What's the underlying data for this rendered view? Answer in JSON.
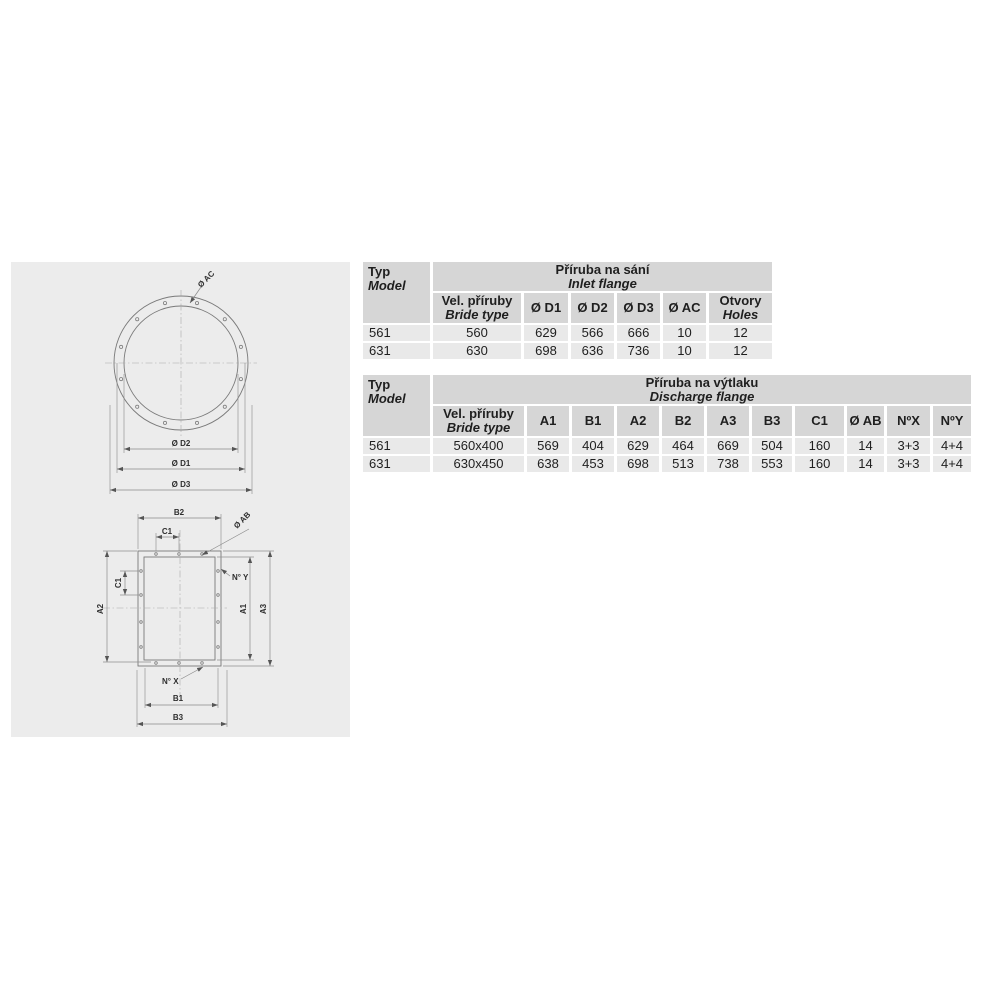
{
  "colors": {
    "page_background": "#ffffff",
    "panel_background": "#ececec",
    "header_cell": "#d6d6d6",
    "data_cell": "#e9e9e9",
    "text": "#1f1f1f",
    "drawing_line": "#7a7a7a"
  },
  "drawing": {
    "circle": {
      "hole_dia_label": "Ø AC",
      "d2": "Ø D2",
      "d1": "Ø D1",
      "d3": "Ø D3"
    },
    "rect": {
      "b2": "B2",
      "c1_top": "C1",
      "hole_dia_label": "Ø AB",
      "ny": "N° Y",
      "c1_left": "C1",
      "a2": "A2",
      "a1": "A1",
      "a3": "A3",
      "nx": "N° X",
      "b1": "B1",
      "b3": "B3"
    }
  },
  "tables": {
    "inlet": {
      "corner": {
        "line1": "Typ",
        "line2": "Model"
      },
      "title": {
        "line1": "Příruba na sání",
        "line2": "Inlet flange"
      },
      "columns": [
        {
          "line1": "Vel. příruby",
          "line2": "Bride type"
        },
        {
          "line1": "Ø D1"
        },
        {
          "line1": "Ø D2"
        },
        {
          "line1": "Ø D3"
        },
        {
          "line1": "Ø AC"
        },
        {
          "line1": "Otvory",
          "line2": "Holes"
        }
      ],
      "rows": [
        {
          "model": "561",
          "values": [
            "560",
            "629",
            "566",
            "666",
            "10",
            "12"
          ]
        },
        {
          "model": "631",
          "values": [
            "630",
            "698",
            "636",
            "736",
            "10",
            "12"
          ]
        }
      ]
    },
    "discharge": {
      "corner": {
        "line1": "Typ",
        "line2": "Model"
      },
      "title": {
        "line1": "Příruba na výtlaku",
        "line2": "Discharge flange"
      },
      "columns": [
        {
          "line1": "Vel. příruby",
          "line2": "Bride type"
        },
        {
          "line1": "A1"
        },
        {
          "line1": "B1"
        },
        {
          "line1": "A2"
        },
        {
          "line1": "B2"
        },
        {
          "line1": "A3"
        },
        {
          "line1": "B3"
        },
        {
          "line1": "C1"
        },
        {
          "line1": "Ø AB"
        },
        {
          "line1": "NºX"
        },
        {
          "line1": "NºY"
        }
      ],
      "rows": [
        {
          "model": "561",
          "values": [
            "560x400",
            "569",
            "404",
            "629",
            "464",
            "669",
            "504",
            "160",
            "14",
            "3+3",
            "4+4"
          ]
        },
        {
          "model": "631",
          "values": [
            "630x450",
            "638",
            "453",
            "698",
            "513",
            "738",
            "553",
            "160",
            "14",
            "3+3",
            "4+4"
          ]
        }
      ]
    }
  }
}
